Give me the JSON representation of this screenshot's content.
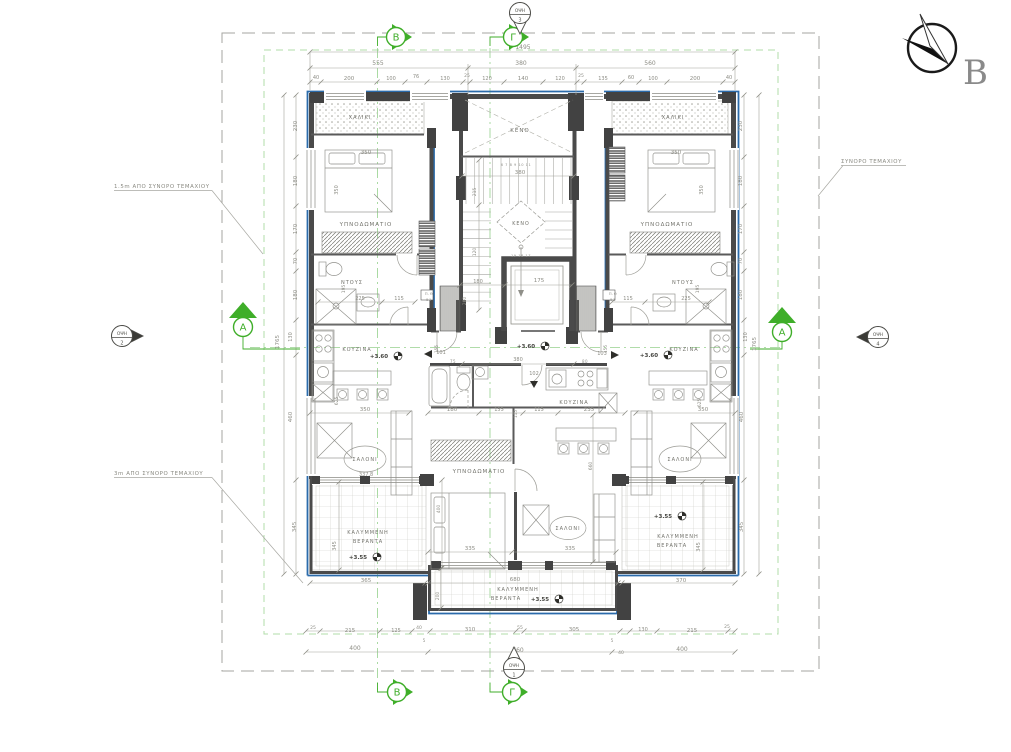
{
  "drawing": {
    "type": "architectural floor plan",
    "colors": {
      "wall": "#4a4a4a",
      "blue_envelope": "#2b6bab",
      "marker_green": "#3fae29",
      "setback_green": "#a9d8a0",
      "dim_text": "#8d8d85",
      "room_text": "#73736c",
      "level_text": "#44443f"
    }
  },
  "compass": {
    "letter": "B"
  },
  "boundary_labels": [
    {
      "name": "setback-1-5m-label",
      "text": "1.5m ΑΠΟ ΣΥΝΟΡΟ ΤΕΜΑΧΙΟΥ",
      "x": 114,
      "y": 188
    },
    {
      "name": "setback-3m-label",
      "text": "3m ΑΠΟ ΣΥΝΟΡΟ ΤΕΜΑΧΙΟΥ",
      "x": 114,
      "y": 475
    },
    {
      "name": "plot-boundary-label",
      "text": "ΣΥΝΟΡΟ ΤΕΜΑΧΙΟΥ",
      "x": 841,
      "y": 163
    }
  ],
  "grid_markers": [
    {
      "label": "B",
      "x": 396,
      "y": 37,
      "dir": "right"
    },
    {
      "label": "Γ",
      "x": 513,
      "y": 37,
      "dir": "right"
    },
    {
      "label": "B",
      "x": 397,
      "y": 692,
      "dir": "right"
    },
    {
      "label": "Γ",
      "x": 512,
      "y": 692,
      "dir": "right"
    },
    {
      "label": "A",
      "x": 243,
      "y": 322,
      "dir": "up"
    },
    {
      "label": "A",
      "x": 782,
      "y": 327,
      "dir": "up"
    }
  ],
  "view_markers": [
    {
      "label": "ΟΨΗ",
      "num": "3",
      "x": 520,
      "y": 13,
      "dir": "down"
    },
    {
      "label": "ΟΨΗ",
      "num": "1",
      "x": 514,
      "y": 668,
      "dir": "up"
    },
    {
      "label": "ΟΨΗ",
      "num": "2",
      "x": 122,
      "y": 336,
      "dir": "right"
    },
    {
      "label": "ΟΨΗ",
      "num": "4",
      "x": 878,
      "y": 337,
      "dir": "left"
    }
  ],
  "annotations": [
    {
      "t": "1495",
      "x": 523,
      "y": 49,
      "r": 0,
      "s": 6,
      "c": "d"
    },
    {
      "t": "555",
      "x": 378,
      "y": 65,
      "r": 0,
      "s": 6,
      "c": "d"
    },
    {
      "t": "380",
      "x": 521,
      "y": 65,
      "r": 0,
      "s": 6,
      "c": "d"
    },
    {
      "t": "560",
      "x": 650,
      "y": 65,
      "r": 0,
      "s": 6,
      "c": "d"
    },
    {
      "t": "40",
      "x": 316,
      "y": 79,
      "r": 0,
      "s": 5,
      "c": "d"
    },
    {
      "t": "200",
      "x": 349,
      "y": 80,
      "r": 0,
      "s": 5.5,
      "c": "d"
    },
    {
      "t": "100",
      "x": 391,
      "y": 80,
      "r": 0,
      "s": 5,
      "c": "d"
    },
    {
      "t": "76",
      "x": 416,
      "y": 78,
      "r": 0,
      "s": 5,
      "c": "d"
    },
    {
      "t": "130",
      "x": 445,
      "y": 80,
      "r": 0,
      "s": 5,
      "c": "d"
    },
    {
      "t": "25",
      "x": 467,
      "y": 77,
      "r": 0,
      "s": 4.5,
      "c": "d"
    },
    {
      "t": "120",
      "x": 487,
      "y": 80,
      "r": 0,
      "s": 5,
      "c": "d"
    },
    {
      "t": "140",
      "x": 523,
      "y": 80,
      "r": 0,
      "s": 5.5,
      "c": "d"
    },
    {
      "t": "120",
      "x": 560,
      "y": 80,
      "r": 0,
      "s": 5,
      "c": "d"
    },
    {
      "t": "25",
      "x": 581,
      "y": 77,
      "r": 0,
      "s": 4.5,
      "c": "d"
    },
    {
      "t": "135",
      "x": 603,
      "y": 80,
      "r": 0,
      "s": 5,
      "c": "d"
    },
    {
      "t": "60",
      "x": 631,
      "y": 79,
      "r": 0,
      "s": 5,
      "c": "d"
    },
    {
      "t": "100",
      "x": 653,
      "y": 80,
      "r": 0,
      "s": 5,
      "c": "d"
    },
    {
      "t": "200",
      "x": 695,
      "y": 80,
      "r": 0,
      "s": 5.5,
      "c": "d"
    },
    {
      "t": "40",
      "x": 729,
      "y": 79,
      "r": 0,
      "s": 5,
      "c": "d"
    },
    {
      "t": "230",
      "x": 297,
      "y": 126,
      "r": -90,
      "s": 5.5,
      "c": "d"
    },
    {
      "t": "180",
      "x": 297,
      "y": 181,
      "r": -90,
      "s": 5.5,
      "c": "d"
    },
    {
      "t": "170",
      "x": 297,
      "y": 229,
      "r": -90,
      "s": 5.5,
      "c": "d"
    },
    {
      "t": "70",
      "x": 297,
      "y": 261,
      "r": -90,
      "s": 5,
      "c": "d"
    },
    {
      "t": "180",
      "x": 297,
      "y": 295,
      "r": -90,
      "s": 5.5,
      "c": "d"
    },
    {
      "t": "130",
      "x": 292,
      "y": 337,
      "r": -90,
      "s": 5,
      "c": "d"
    },
    {
      "t": "460",
      "x": 292,
      "y": 417,
      "r": -90,
      "s": 5.5,
      "c": "d"
    },
    {
      "t": "345",
      "x": 296,
      "y": 527,
      "r": -90,
      "s": 5.5,
      "c": "d"
    },
    {
      "t": "1765",
      "x": 279,
      "y": 342,
      "r": -90,
      "s": 5.5,
      "c": "d"
    },
    {
      "t": "230",
      "x": 742,
      "y": 126,
      "r": -90,
      "s": 5.5,
      "c": "d"
    },
    {
      "t": "180",
      "x": 742,
      "y": 181,
      "r": -90,
      "s": 5.5,
      "c": "d"
    },
    {
      "t": "170",
      "x": 742,
      "y": 229,
      "r": -90,
      "s": 5.5,
      "c": "d"
    },
    {
      "t": "70",
      "x": 742,
      "y": 261,
      "r": -90,
      "s": 5,
      "c": "d"
    },
    {
      "t": "180",
      "x": 742,
      "y": 295,
      "r": -90,
      "s": 5.5,
      "c": "d"
    },
    {
      "t": "130",
      "x": 747,
      "y": 337,
      "r": -90,
      "s": 5,
      "c": "d"
    },
    {
      "t": "460",
      "x": 743,
      "y": 417,
      "r": -90,
      "s": 5.5,
      "c": "d"
    },
    {
      "t": "345",
      "x": 743,
      "y": 527,
      "r": -90,
      "s": 5.5,
      "c": "d"
    },
    {
      "t": "1765",
      "x": 756,
      "y": 344,
      "r": -90,
      "s": 5.5,
      "c": "d"
    },
    {
      "t": "25",
      "x": 313,
      "y": 629,
      "r": 0,
      "s": 4.5,
      "c": "d"
    },
    {
      "t": "215",
      "x": 350,
      "y": 632,
      "r": 0,
      "s": 5.5,
      "c": "d"
    },
    {
      "t": "125",
      "x": 396,
      "y": 632,
      "r": 0,
      "s": 5,
      "c": "d"
    },
    {
      "t": "40",
      "x": 419,
      "y": 629,
      "r": 0,
      "s": 4.5,
      "c": "d"
    },
    {
      "t": "5",
      "x": 424,
      "y": 642,
      "r": 0,
      "s": 4,
      "c": "d"
    },
    {
      "t": "310",
      "x": 470,
      "y": 631,
      "r": 0,
      "s": 5.5,
      "c": "d"
    },
    {
      "t": "55",
      "x": 520,
      "y": 629,
      "r": 0,
      "s": 4.5,
      "c": "d"
    },
    {
      "t": "305",
      "x": 574,
      "y": 631,
      "r": 0,
      "s": 5.5,
      "c": "d"
    },
    {
      "t": "5",
      "x": 612,
      "y": 642,
      "r": 0,
      "s": 4,
      "c": "d"
    },
    {
      "t": "130",
      "x": 643,
      "y": 631,
      "r": 0,
      "s": 5,
      "c": "d"
    },
    {
      "t": "215",
      "x": 692,
      "y": 632,
      "r": 0,
      "s": 5.5,
      "c": "d"
    },
    {
      "t": "25",
      "x": 727,
      "y": 628,
      "r": 0,
      "s": 4.5,
      "c": "d"
    },
    {
      "t": "400",
      "x": 355,
      "y": 650,
      "r": 0,
      "s": 6,
      "c": "d"
    },
    {
      "t": "760",
      "x": 518,
      "y": 652,
      "r": 0,
      "s": 6,
      "c": "d"
    },
    {
      "t": "40",
      "x": 621,
      "y": 654,
      "r": 0,
      "s": 4.5,
      "c": "d"
    },
    {
      "t": "400",
      "x": 682,
      "y": 651,
      "r": 0,
      "s": 6,
      "c": "d"
    },
    {
      "t": "ΧΑΛΙΚΙ",
      "x": 360,
      "y": 119,
      "r": 0,
      "s": 5,
      "c": "r"
    },
    {
      "t": "350",
      "x": 366,
      "y": 154,
      "r": 0,
      "s": 5.5,
      "c": "d"
    },
    {
      "t": "350",
      "x": 338,
      "y": 190,
      "r": -90,
      "s": 5,
      "c": "d"
    },
    {
      "t": "ΥΠΝΟΔΩΜΑΤΙΟ",
      "x": 366,
      "y": 226,
      "r": 0,
      "s": 5.5,
      "c": "r"
    },
    {
      "t": "ΝΤΟΥΣ",
      "x": 352,
      "y": 284,
      "r": 0,
      "s": 5,
      "c": "r"
    },
    {
      "t": "195",
      "x": 345,
      "y": 289,
      "r": -90,
      "s": 4.5,
      "c": "d"
    },
    {
      "t": "225",
      "x": 360,
      "y": 300,
      "r": 0,
      "s": 5,
      "c": "d"
    },
    {
      "t": "115",
      "x": 399,
      "y": 300,
      "r": 0,
      "s": 5,
      "c": "d"
    },
    {
      "t": "Π.Θ",
      "x": 429,
      "y": 295,
      "r": 0,
      "s": 3.8,
      "c": "t"
    },
    {
      "t": "51",
      "x": 429,
      "y": 301,
      "r": 0,
      "s": 3.8,
      "c": "t"
    },
    {
      "t": "ΚΟΥΖΙΝΑ",
      "x": 357,
      "y": 351,
      "r": 0,
      "s": 5,
      "c": "r"
    },
    {
      "t": "+3.60",
      "x": 379,
      "y": 358,
      "r": 0,
      "s": 5.5,
      "c": "l"
    },
    {
      "t": "101",
      "x": 441,
      "y": 354,
      "r": 0,
      "s": 5,
      "c": "d"
    },
    {
      "t": "75",
      "x": 453,
      "y": 363,
      "r": 0,
      "s": 4,
      "c": "t"
    },
    {
      "t": "625",
      "x": 338,
      "y": 401,
      "r": -90,
      "s": 4.5,
      "c": "d"
    },
    {
      "t": "350",
      "x": 365,
      "y": 411,
      "r": 0,
      "s": 5.5,
      "c": "d"
    },
    {
      "t": "ΣΑΛΟΝΙ",
      "x": 365,
      "y": 461,
      "r": 0,
      "s": 5,
      "c": "r"
    },
    {
      "t": "337.8",
      "x": 366,
      "y": 476,
      "r": 0,
      "s": 5,
      "c": "d"
    },
    {
      "t": "ΚΑΛΥΜΜΕΝΗ",
      "x": 368,
      "y": 534,
      "r": 0,
      "s": 5,
      "c": "r"
    },
    {
      "t": "ΒΕΡΑΝΤΑ",
      "x": 368,
      "y": 543,
      "r": 0,
      "s": 5,
      "c": "r"
    },
    {
      "t": "+3.55",
      "x": 358,
      "y": 559,
      "r": 0,
      "s": 5.5,
      "c": "l"
    },
    {
      "t": "345",
      "x": 336,
      "y": 546,
      "r": -90,
      "s": 5,
      "c": "d"
    },
    {
      "t": "365",
      "x": 366,
      "y": 582,
      "r": 0,
      "s": 5.5,
      "c": "d"
    },
    {
      "t": "ΚΕΝΟ",
      "x": 520,
      "y": 132,
      "r": 0,
      "s": 5.5,
      "c": "r"
    },
    {
      "t": "380",
      "x": 520,
      "y": 174,
      "r": 0,
      "s": 5.5,
      "c": "d"
    },
    {
      "t": "6 7 8 9 10 11",
      "x": 516,
      "y": 166,
      "r": 0,
      "s": 3.6,
      "c": "t"
    },
    {
      "t": "215",
      "x": 476,
      "y": 192,
      "r": -90,
      "s": 4.5,
      "c": "d"
    },
    {
      "t": "ΚΕΝΟ",
      "x": 521,
      "y": 225,
      "r": 0,
      "s": 4.8,
      "c": "r"
    },
    {
      "t": "120",
      "x": 476,
      "y": 252,
      "r": -90,
      "s": 4.5,
      "c": "d"
    },
    {
      "t": "19 18 17",
      "x": 521,
      "y": 257,
      "r": 0,
      "s": 3.6,
      "c": "t"
    },
    {
      "t": "180",
      "x": 478,
      "y": 283,
      "r": 0,
      "s": 5,
      "c": "d"
    },
    {
      "t": "175",
      "x": 539,
      "y": 282,
      "r": 0,
      "s": 5.5,
      "c": "d"
    },
    {
      "t": "200",
      "x": 466,
      "y": 301,
      "r": -90,
      "s": 4.5,
      "c": "d"
    },
    {
      "t": "155",
      "x": 438,
      "y": 349,
      "r": -90,
      "s": 4.2,
      "c": "d"
    },
    {
      "t": "155",
      "x": 607,
      "y": 349,
      "r": -90,
      "s": 4.2,
      "c": "d"
    },
    {
      "t": "+3.60",
      "x": 526,
      "y": 348,
      "r": 0,
      "s": 5.5,
      "c": "l"
    },
    {
      "t": "380",
      "x": 518,
      "y": 361,
      "r": 0,
      "s": 5,
      "c": "d"
    },
    {
      "t": "102",
      "x": 534,
      "y": 375,
      "r": 0,
      "s": 5,
      "c": "d"
    },
    {
      "t": "80",
      "x": 585,
      "y": 363,
      "r": 0,
      "s": 4,
      "c": "t"
    },
    {
      "t": "Π.Θ",
      "x": 613,
      "y": 295,
      "r": 0,
      "s": 3.8,
      "c": "t"
    },
    {
      "t": "51",
      "x": 613,
      "y": 301,
      "r": 0,
      "s": 3.8,
      "c": "t"
    },
    {
      "t": "180",
      "x": 452,
      "y": 411,
      "r": 0,
      "s": 5.5,
      "c": "d"
    },
    {
      "t": "155",
      "x": 499,
      "y": 411,
      "r": 0,
      "s": 5,
      "c": "d"
    },
    {
      "t": "115",
      "x": 517,
      "y": 414,
      "r": -90,
      "s": 4.2,
      "c": "d"
    },
    {
      "t": "115",
      "x": 539,
      "y": 411,
      "r": 0,
      "s": 5,
      "c": "d"
    },
    {
      "t": "235",
      "x": 589,
      "y": 411,
      "r": 0,
      "s": 5.5,
      "c": "d"
    },
    {
      "t": "ΚΟΥΖΙΝΑ",
      "x": 574,
      "y": 404,
      "r": 0,
      "s": 5,
      "c": "r"
    },
    {
      "t": "660",
      "x": 592,
      "y": 466,
      "r": -90,
      "s": 4.5,
      "c": "d"
    },
    {
      "t": "400",
      "x": 440,
      "y": 509,
      "r": -90,
      "s": 4.5,
      "c": "d"
    },
    {
      "t": "ΥΠΝΟΔΩΜΑΤΙΟ",
      "x": 479,
      "y": 473,
      "r": 0,
      "s": 5.5,
      "c": "r"
    },
    {
      "t": "335",
      "x": 470,
      "y": 550,
      "r": 0,
      "s": 5.5,
      "c": "d"
    },
    {
      "t": "335",
      "x": 570,
      "y": 550,
      "r": 0,
      "s": 5.5,
      "c": "d"
    },
    {
      "t": "ΣΑΛΟΝΙ",
      "x": 568,
      "y": 530,
      "r": 0,
      "s": 5,
      "c": "r"
    },
    {
      "t": "680",
      "x": 515,
      "y": 581,
      "r": 0,
      "s": 5.5,
      "c": "d"
    },
    {
      "t": "ΚΑΛΥΜΜΕΝΗ",
      "x": 518,
      "y": 591,
      "r": 0,
      "s": 5,
      "c": "r"
    },
    {
      "t": "ΒΕΡΑΝΤΑ",
      "x": 506,
      "y": 600,
      "r": 0,
      "s": 5,
      "c": "r"
    },
    {
      "t": "+3.55",
      "x": 540,
      "y": 601,
      "r": 0,
      "s": 5.5,
      "c": "l"
    },
    {
      "t": "200",
      "x": 439,
      "y": 596,
      "r": -90,
      "s": 4.5,
      "c": "d"
    },
    {
      "t": "103",
      "x": 602,
      "y": 355,
      "r": 0,
      "s": 5,
      "c": "d"
    },
    {
      "t": "ΧΑΛΙΚΙ",
      "x": 673,
      "y": 119,
      "r": 0,
      "s": 5,
      "c": "r"
    },
    {
      "t": "350",
      "x": 676,
      "y": 154,
      "r": 0,
      "s": 5.5,
      "c": "d"
    },
    {
      "t": "350",
      "x": 703,
      "y": 190,
      "r": -90,
      "s": 5,
      "c": "d"
    },
    {
      "t": "ΥΠΝΟΔΩΜΑΤΙΟ",
      "x": 667,
      "y": 226,
      "r": 0,
      "s": 5.5,
      "c": "r"
    },
    {
      "t": "ΝΤΟΥΣ",
      "x": 683,
      "y": 284,
      "r": 0,
      "s": 5,
      "c": "r"
    },
    {
      "t": "195",
      "x": 699,
      "y": 289,
      "r": -90,
      "s": 4.5,
      "c": "d"
    },
    {
      "t": "115",
      "x": 628,
      "y": 300,
      "r": 0,
      "s": 5,
      "c": "d"
    },
    {
      "t": "225",
      "x": 686,
      "y": 300,
      "r": 0,
      "s": 5,
      "c": "d"
    },
    {
      "t": "+3.60",
      "x": 649,
      "y": 357,
      "r": 0,
      "s": 5.5,
      "c": "l"
    },
    {
      "t": "ΚΟΥΖΙΝΑ",
      "x": 684,
      "y": 351,
      "r": 0,
      "s": 5,
      "c": "r"
    },
    {
      "t": "625",
      "x": 701,
      "y": 403,
      "r": -90,
      "s": 4.5,
      "c": "d"
    },
    {
      "t": "350",
      "x": 703,
      "y": 411,
      "r": 0,
      "s": 5.5,
      "c": "d"
    },
    {
      "t": "ΣΑΛΟΝΙ",
      "x": 680,
      "y": 461,
      "r": 0,
      "s": 5,
      "c": "r"
    },
    {
      "t": "+3.55",
      "x": 663,
      "y": 518,
      "r": 0,
      "s": 5.5,
      "c": "l"
    },
    {
      "t": "ΚΑΛΥΜΜΕΝΗ",
      "x": 678,
      "y": 538,
      "r": 0,
      "s": 5,
      "c": "r"
    },
    {
      "t": "ΒΕΡΑΝΤΑ",
      "x": 672,
      "y": 547,
      "r": 0,
      "s": 5,
      "c": "r"
    },
    {
      "t": "345",
      "x": 700,
      "y": 547,
      "r": -90,
      "s": 5,
      "c": "d"
    },
    {
      "t": "370",
      "x": 681,
      "y": 582,
      "r": 0,
      "s": 5.5,
      "c": "d"
    }
  ]
}
